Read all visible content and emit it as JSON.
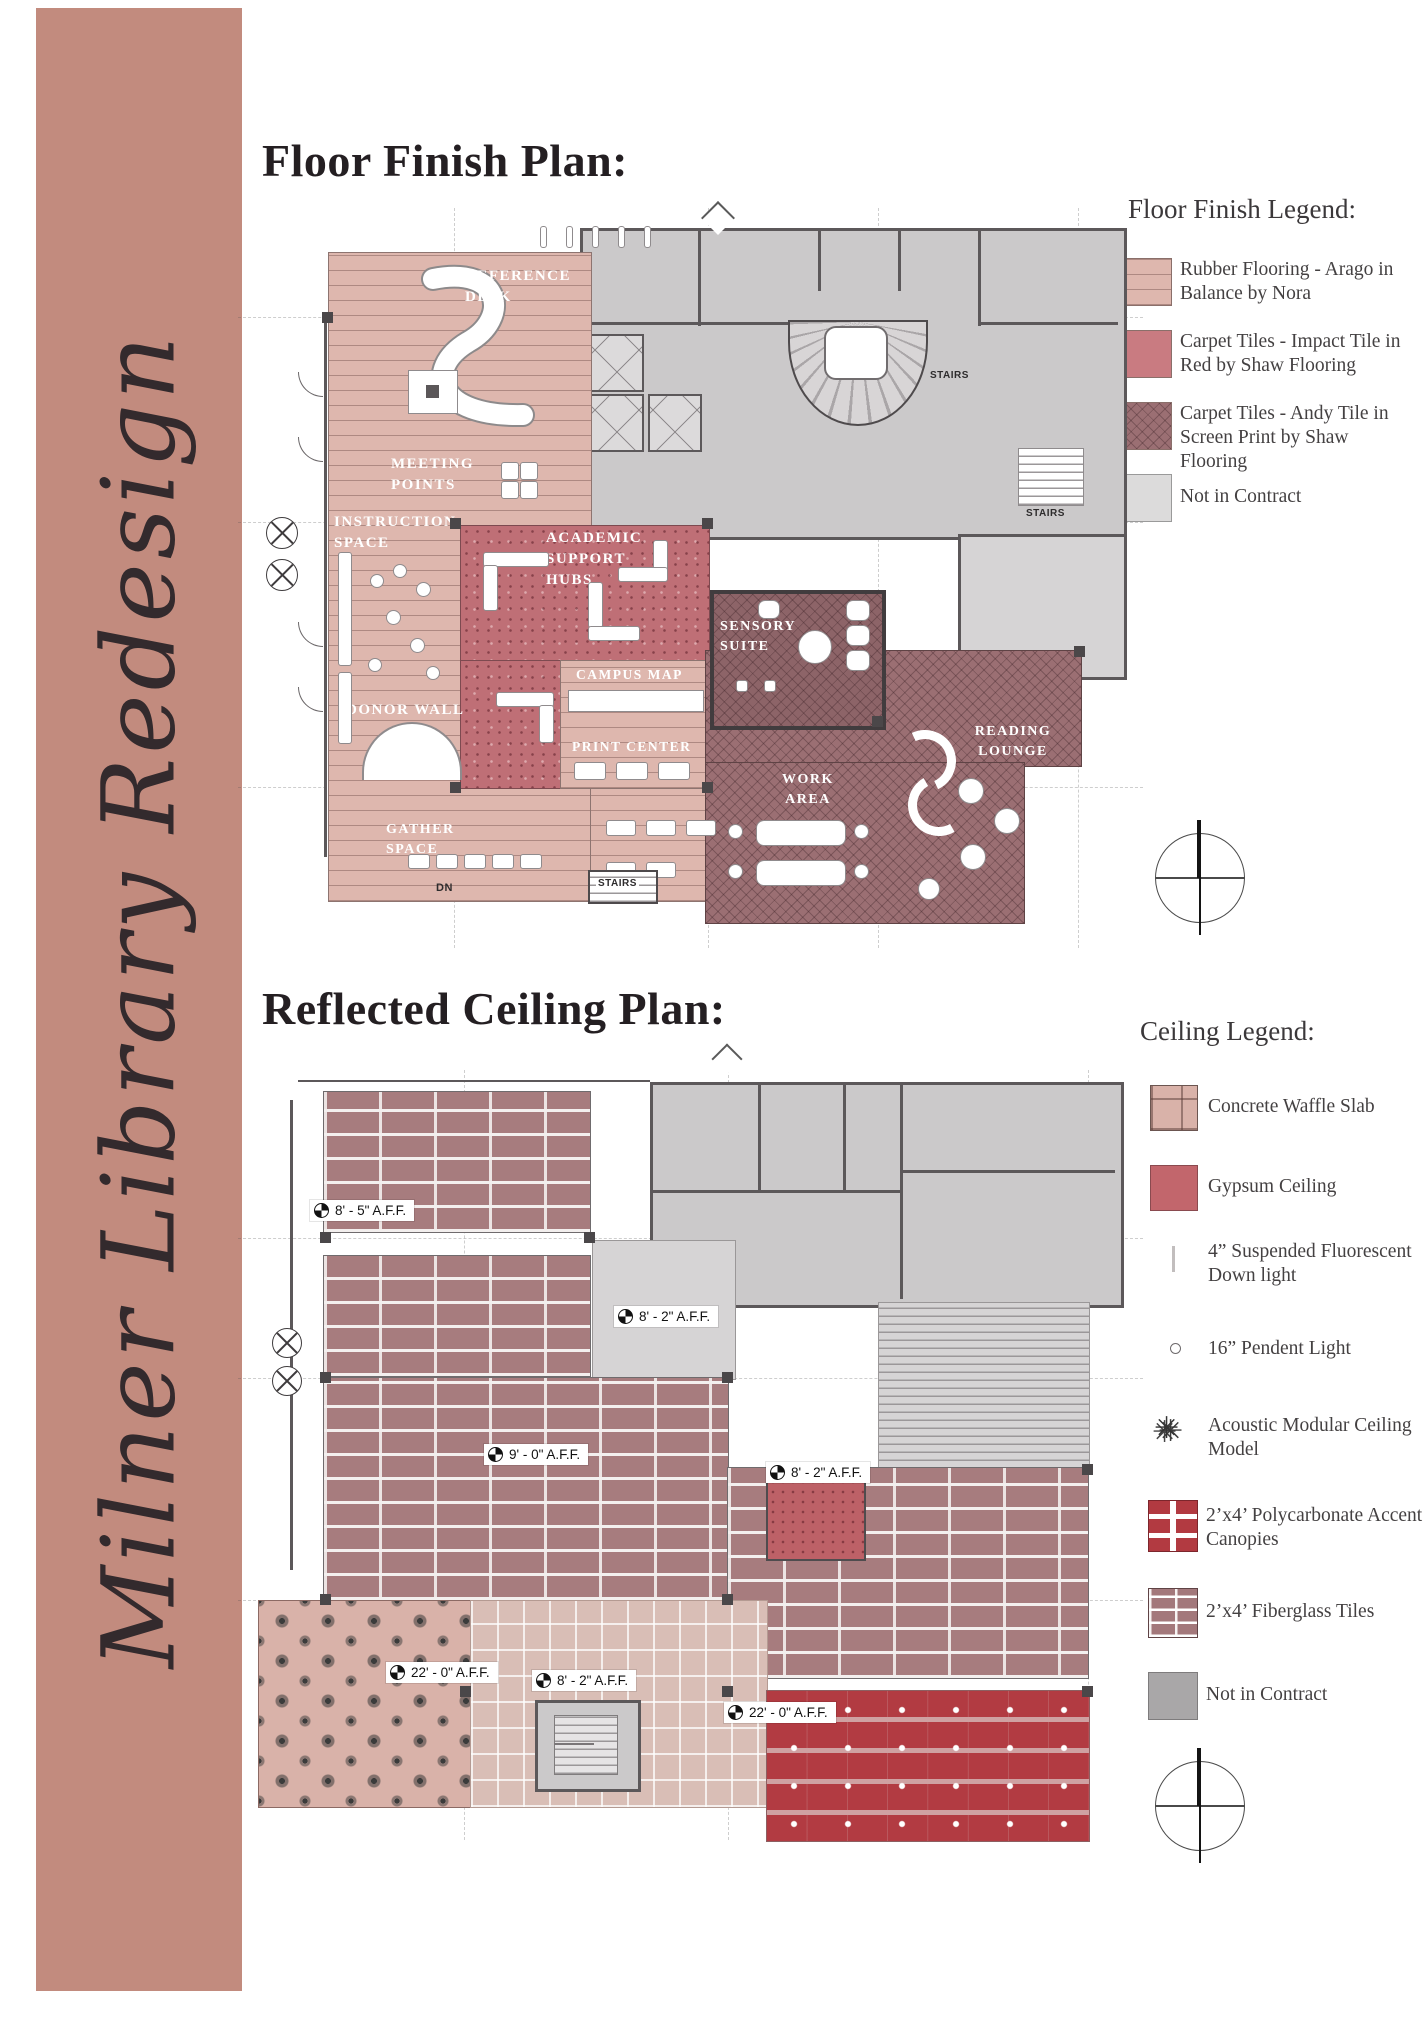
{
  "page": {
    "sidebar_title": "Milner Library Redesign",
    "band_color": "#c28b7e"
  },
  "floor": {
    "title": "Floor Finish Plan:",
    "legend_title": "Floor Finish Legend:",
    "legend": [
      {
        "label": "Rubber Flooring - Arago in Balance by Nora",
        "swatch": "rubber-stripes",
        "color": "#deb7ae"
      },
      {
        "label": "Carpet Tiles - Impact Tile in Red by Shaw Flooring",
        "swatch": "solid",
        "color": "#c97b81"
      },
      {
        "label": "Carpet Tiles - Andy Tile in Screen Print by Shaw Flooring",
        "swatch": "crosshatch",
        "color": "#a3777a"
      },
      {
        "label": "Not in Contract",
        "swatch": "solid",
        "color": "#dcdbdb"
      }
    ],
    "rooms": {
      "reference_desk": "REFERENCE DESK",
      "meeting_points": "MEETING POINTS",
      "instruction_space": "INSTRUCTION SPACE",
      "academic_support_hubs": "ACADEMIC SUPPORT HUBS",
      "sensory_suite": "SENSORY SUITE",
      "campus_map": "CAMPUS MAP",
      "print_center": "PRINT CENTER",
      "donor_wall": "DONOR WALL",
      "work_area": "WORK AREA",
      "reading_lounge": "READING LOUNGE",
      "gather_space": "GATHER SPACE"
    },
    "annotations": {
      "stairs_top": "STAIRS",
      "stairs_right": "STAIRS",
      "stairs_bottom": "STAIRS",
      "dn": "DN"
    }
  },
  "ceiling": {
    "title": "Reflected Ceiling Plan:",
    "legend_title": "Ceiling Legend:",
    "legend": [
      {
        "label": "Concrete Waffle Slab",
        "swatch": "waffle"
      },
      {
        "label": "Gypsum Ceiling",
        "swatch": "solid",
        "color": "#c2666c"
      },
      {
        "label": "4” Suspended Fluorescent Down light",
        "swatch": "fluorescent-line"
      },
      {
        "label": "16” Pendent Light",
        "swatch": "pendant-circle"
      },
      {
        "label": "Acoustic Modular Ceiling Model",
        "swatch": "scribble"
      },
      {
        "label": "2’x4’ Polycarbonate Accent Canopies",
        "swatch": "canopy-grid"
      },
      {
        "label": "2’x4’ Fiberglass Tiles",
        "swatch": "brick"
      },
      {
        "label": "Not in Contract",
        "swatch": "solid",
        "color": "#a9a7a8"
      }
    ],
    "aff": [
      "8' - 5\"  A.F.F.",
      "8' - 2\"  A.F.F.",
      "9' - 0\"  A.F.F.",
      "8' - 2\"  A.F.F.",
      "22' - 0\"  A.F.F.",
      "8' - 2\"  A.F.F.",
      "22' - 0\"  A.F.F."
    ]
  }
}
